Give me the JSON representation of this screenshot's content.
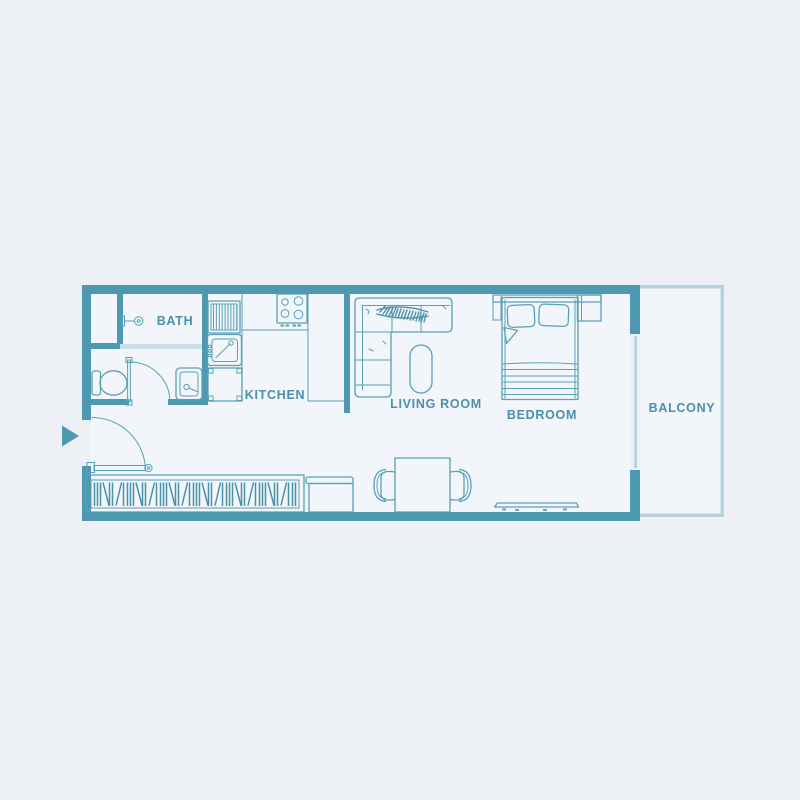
{
  "colors": {
    "bg": "#edf1f6",
    "floor": "#f2f5f9",
    "wall": "#4e99b1",
    "line": "#58a1b7",
    "line-strong": "#4892ab",
    "pale-wall": "#c9dfe8",
    "window-line": "#a9cdd9",
    "balcony-border": "#b5d3df",
    "label": "#4a90aa"
  },
  "rooms": {
    "bath": {
      "label": "BATH"
    },
    "kitchen": {
      "label": "KITCHEN"
    },
    "living_room": {
      "label": "LIVING ROOM"
    },
    "bedroom": {
      "label": "BEDROOM"
    },
    "balcony": {
      "label": "BALCONY"
    }
  }
}
